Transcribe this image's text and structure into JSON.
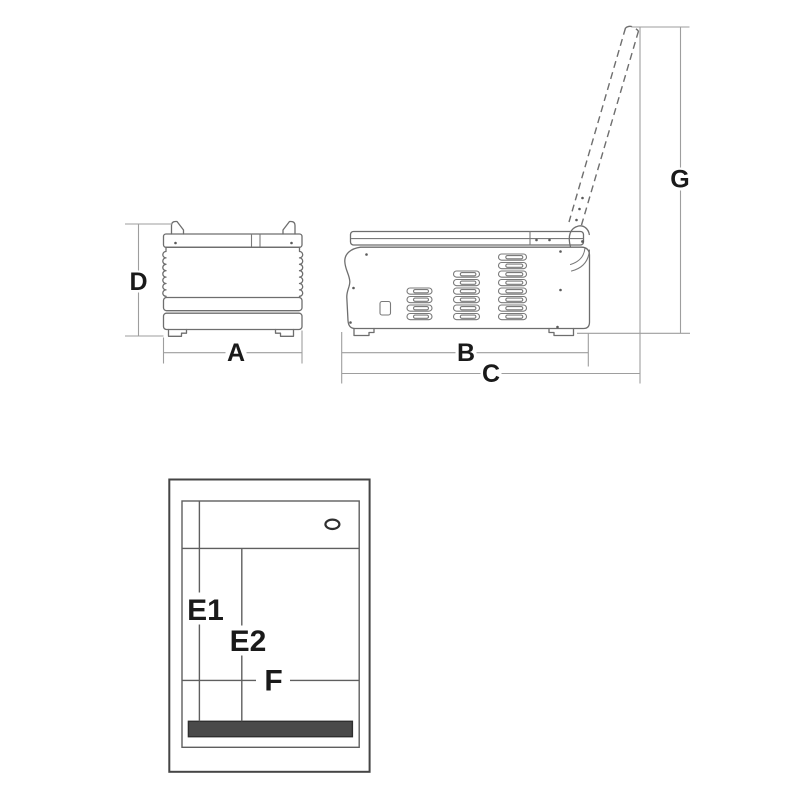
{
  "dimension_labels": {
    "front_width": "A",
    "side_body_width": "B",
    "side_overall_width": "C",
    "front_height": "D",
    "open_lid_height": "G",
    "top_depth_e1": "E1",
    "top_depth_e2": "E2",
    "top_width_f": "F"
  },
  "colors": {
    "background": "#ffffff",
    "machine_outline": "#6e6e6e",
    "frame_outline": "#454545",
    "dimension_line": "#9e9e9e",
    "label_text": "#1a1a1a",
    "seal_bar_fill": "#4a4a4a"
  }
}
